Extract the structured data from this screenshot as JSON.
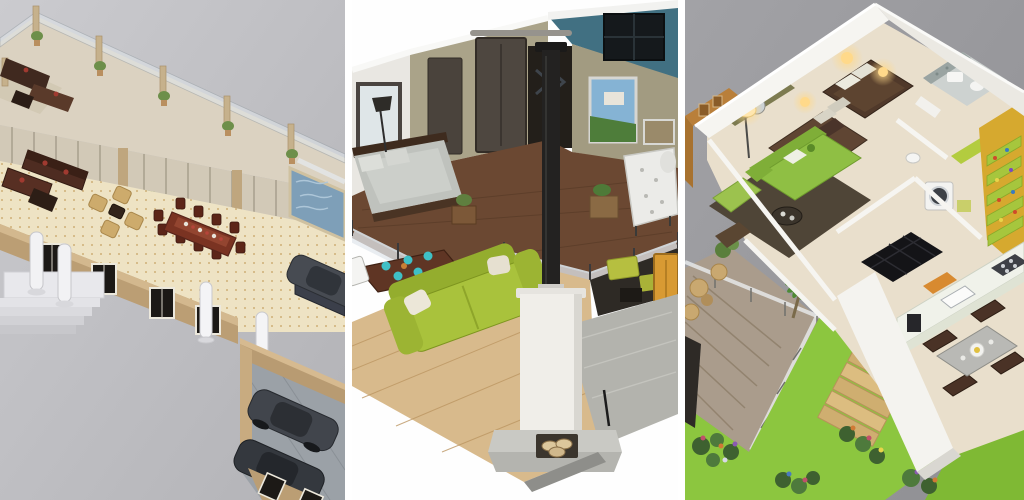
{
  "collage": {
    "title": "Three 3D home floor plan renders",
    "separator_color": "#ffffff",
    "panel_count": 3,
    "panels": [
      {
        "id": "penthouse-plan",
        "alt": "Isometric 3D penthouse floor plan on grey ground: wrap-around terrace with glass balustrade and potted plants, blue plunge pool, dark maroon lounge suites, tan armchair cluster, eight-seat mahogany dining table, tan walls with black shuttered windows, white columned entrance steps and a double garage with two dark cars",
        "background": "#c4c4c8",
        "palette": {
          "floor": "#eee3c4",
          "walls": "#bb9e74",
          "deck": "#dbd2c1",
          "pool": "#7e9fb8",
          "sofa": "#4e2c21",
          "armchair": "#cdab6c",
          "steps": "#e8e8ec",
          "car": "#41454c",
          "plant": "#6d8f4a"
        }
      },
      {
        "id": "loft-cutaway",
        "alt": "3D cutaway render of a two-storey loft on white: mezzanine bedroom with grey bed and metal-glass railing, olive and teal walls, sliding barn door, landscape wall art, black flue over a white masonry fireplace with log store, lime-green sofa, dark dining table with turquoise plates and white chairs, grey rug and amber door",
        "background": "#fefefe",
        "palette": {
          "wall_olive": "#a9a287",
          "wall_teal": "#417082",
          "mezzanine_floor": "#6b4832",
          "oak_floor": "#d8ba8c",
          "sofa": "#a9c23c",
          "chimney": "#f0eee9",
          "flue": "#232221",
          "door": "#d89a33",
          "rug": "#b3b3ad",
          "plates": "#3fc0c6"
        }
      },
      {
        "id": "apartment-plan-garden",
        "alt": "3D apartment floor plan on grey: two bedrooms with dark brown bedding and warm glowing lamps, olive and orange accent walls, green sofa lounge on dark rug, bathroom, laundry with washing machine, lime shelving on a yellow wall, galley kitchen with dining set, timber deck with glass balustrade, wooden stairs and a flowering green garden",
        "background": "#9a9a9e",
        "palette": {
          "wall": "#f4f3ef",
          "floor": "#e9dfcc",
          "sofa": "#8fbf44",
          "bed": "#50392a",
          "accent_orange": "#b97f3a",
          "accent_yellow": "#d6a92f",
          "shelf": "#a6c63d",
          "lawn": "#8cc63f",
          "deck": "#aa9c8c",
          "glow": "#ffd98a"
        }
      }
    ]
  }
}
